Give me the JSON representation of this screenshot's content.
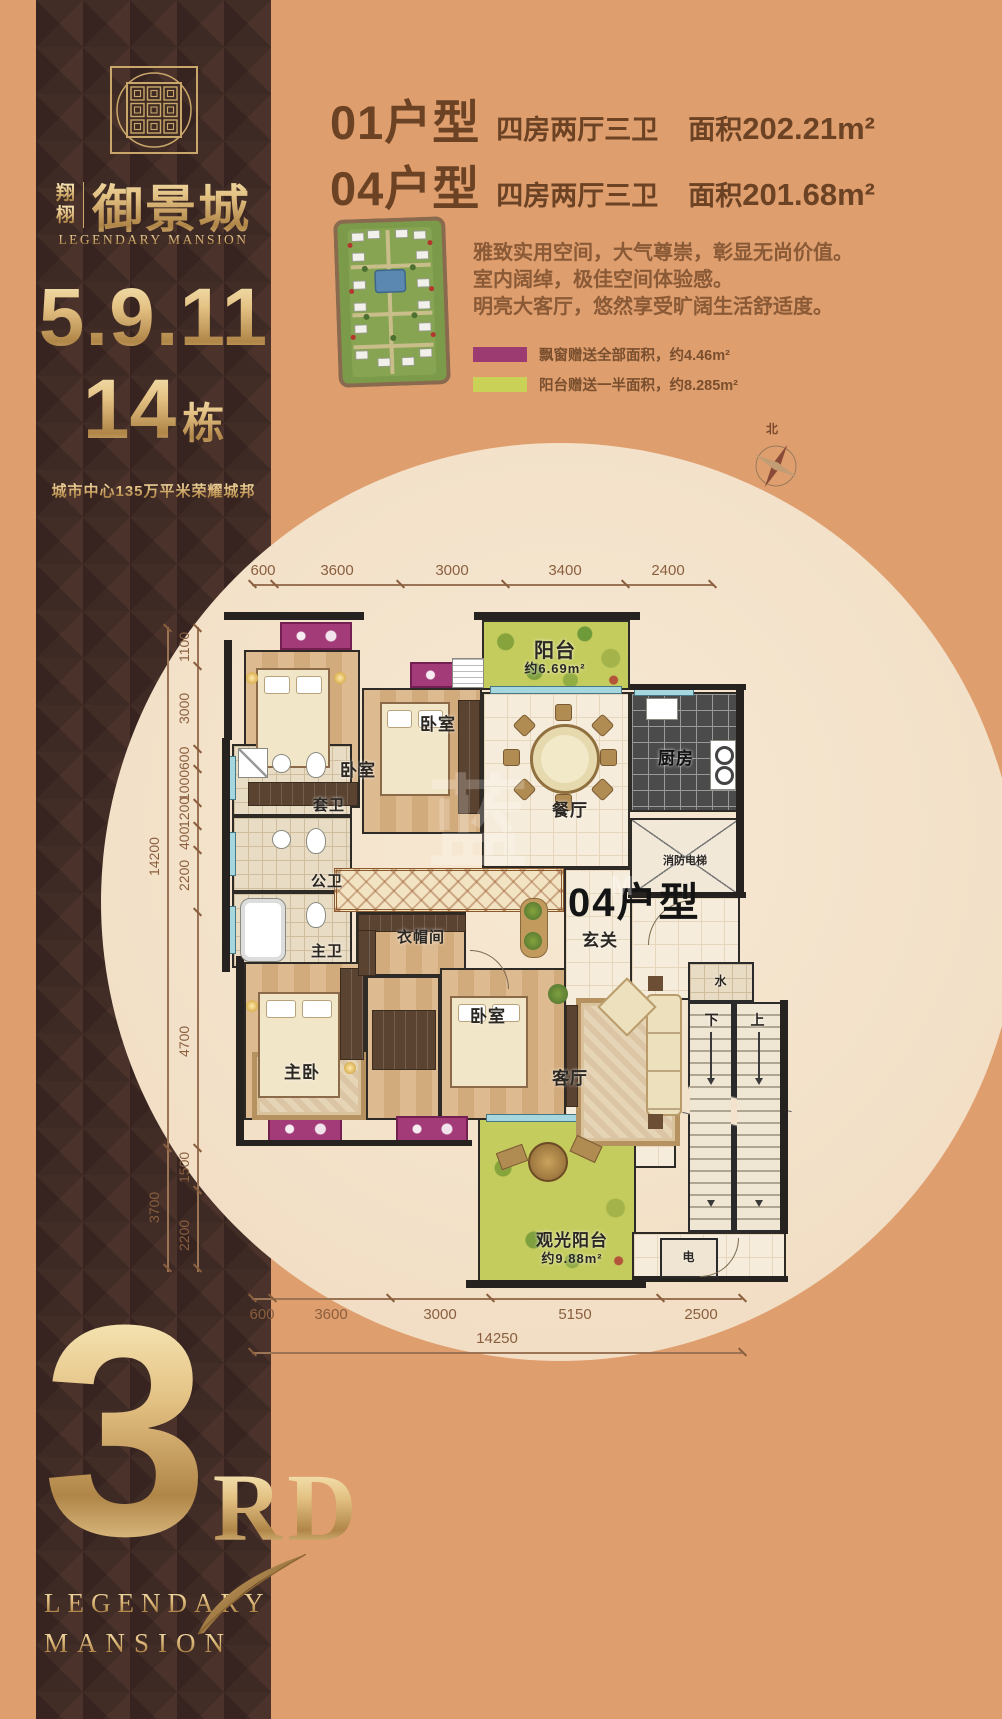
{
  "sidebar": {
    "logo": {
      "cn_small_1": "翔",
      "cn_small_2": "栩",
      "cn_large": "御景城",
      "en": "LEGENDARY MANSION"
    },
    "buildings_line": "5.9.11",
    "building_number": "14",
    "building_suffix": "栋",
    "tagline": "城市中心135万平米荣耀城邦",
    "footer": {
      "big": "3",
      "ord": "RD",
      "en_line1": "LEGENDARY",
      "en_line2": "MANSION"
    }
  },
  "header": {
    "units": [
      {
        "code": "01户型",
        "rooms": "四房两厅三卫",
        "area_label": "面积",
        "area_value": "202.21m²"
      },
      {
        "code": "04户型",
        "rooms": "四房两厅三卫",
        "area_label": "面积",
        "area_value": "201.68m²"
      }
    ]
  },
  "intro": {
    "line1": "雅致实用空间，大气尊崇，彰显无尚价值。",
    "line2": "室内阔绰，极佳空间体验感。",
    "line3": "明亮大客厅，悠然享受旷阔生活舒适度。"
  },
  "legend": {
    "items": [
      {
        "color": "#9c3a72",
        "label": "飘窗赠送全部面积，约4.46m²"
      },
      {
        "color": "#c9d257",
        "label": "阳台赠送一半面积，约8.285m²"
      }
    ]
  },
  "compass": {
    "north": "北"
  },
  "plan": {
    "unit_label": "04户型",
    "rooms": {
      "balcony_top": "阳台",
      "balcony_top_area": "约6.69m²",
      "bedroom": "卧室",
      "kitchen": "厨房",
      "dining": "餐厅",
      "bath_suite": "套卫",
      "bath_public": "公卫",
      "bath_master": "主卫",
      "cloakroom": "衣帽间",
      "entry": "玄关",
      "living": "客厅",
      "master": "主卧",
      "elevator": "消防电梯",
      "water": "水",
      "electric": "电",
      "down": "下",
      "up": "上",
      "balcony_bottom": "观光阳台",
      "balcony_bottom_area": "约9.88m²"
    },
    "dims": {
      "top": [
        "600",
        "3600",
        "3000",
        "3400",
        "2400"
      ],
      "left": [
        "1100",
        "3000",
        "600",
        "1000",
        "1200",
        "400",
        "2200",
        "4700",
        "1500",
        "2200"
      ],
      "left_total": "14200",
      "left_sub_total": "3700",
      "bottom": [
        "600",
        "3600",
        "3000",
        "5150",
        "2500"
      ],
      "bottom_total": "14250"
    }
  },
  "watermark": {
    "glyph": "蓝",
    "letter": "M"
  }
}
